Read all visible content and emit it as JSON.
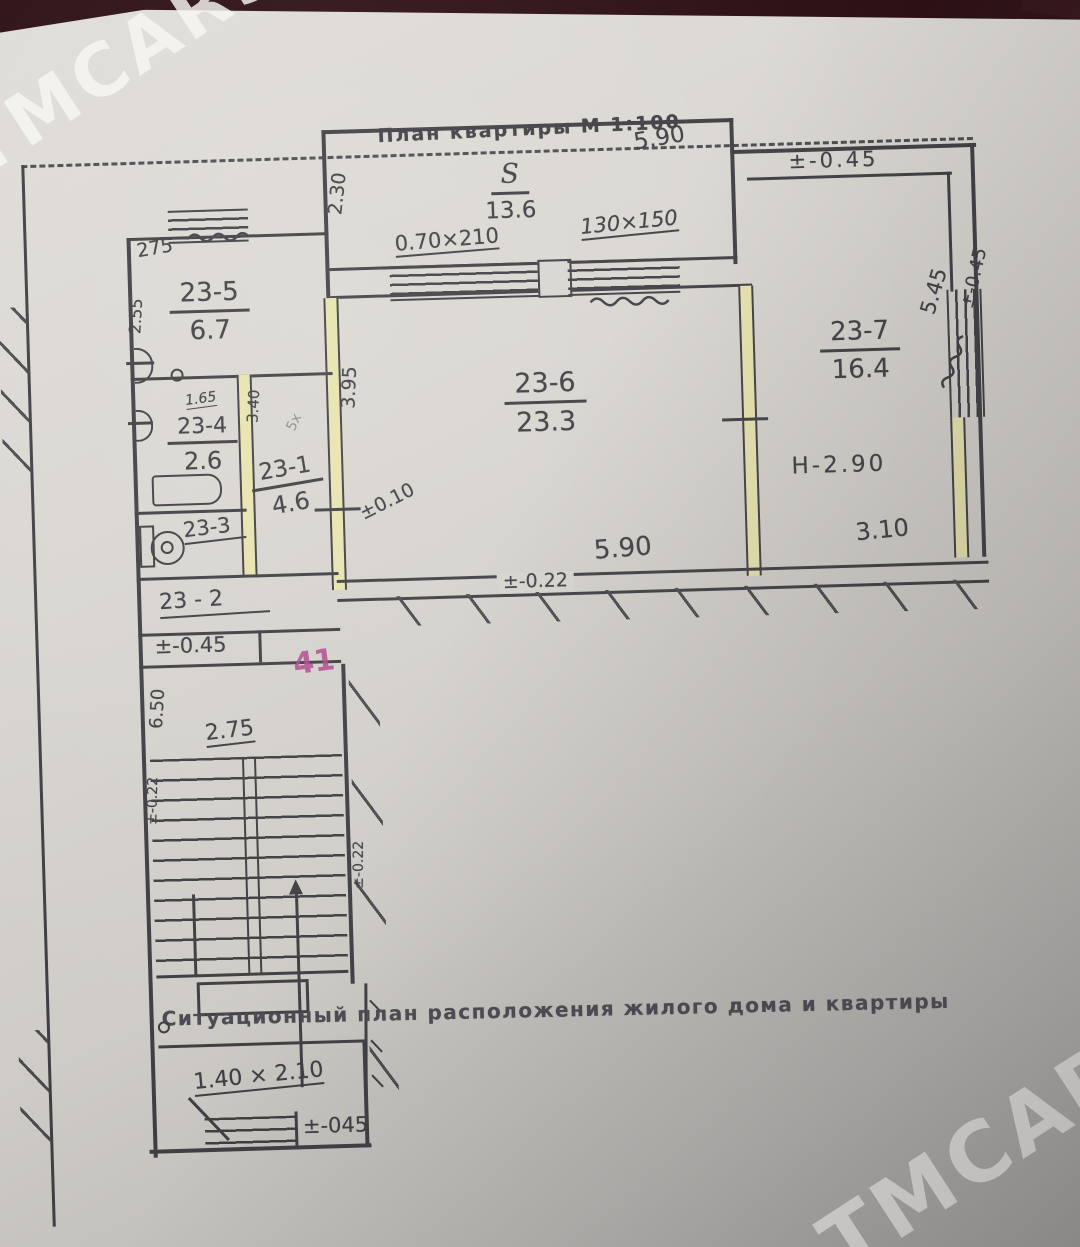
{
  "colors": {
    "ink": "#3f3e43",
    "paper": "#d8d5d0",
    "partition_fill": "#e7e3ae",
    "red_mark": "#b0478d",
    "photo_edge": "#2b0e12"
  },
  "watermark": {
    "text": "TMCARS"
  },
  "header": {
    "title": "План квартиры  М 1:100"
  },
  "balcony": {
    "s_label": "S",
    "area": "13.6",
    "door_dim": "0.70×210",
    "window_dim": "130×150",
    "side_dim": "2.30",
    "top_dim": "5.90"
  },
  "right_wing": {
    "top_level": "±-0.45",
    "side_dim": "5.45",
    "side_level": "±-0.45"
  },
  "rooms": {
    "r237": {
      "number": "23-7",
      "area": "16.4",
      "height_mark": "Н-2.90",
      "width_dim": "3.10"
    },
    "r236": {
      "number": "23-6",
      "area": "23.3",
      "width_dim": "5.90",
      "depth_dim": "3.95",
      "level_mark": "±0.10",
      "bottom_level": "±-0.22"
    },
    "r235": {
      "number": "23-5",
      "area": "6.7",
      "top_dim": "275",
      "side_dim": "2.55"
    },
    "r234": {
      "number": "23-4",
      "area": "2.6",
      "top_dim": "1.65"
    },
    "r233": {
      "number": "23-3"
    },
    "r231": {
      "number": "23-1",
      "area": "4.6",
      "side_dim": "3.40",
      "pencil_note": "5х"
    },
    "r232": {
      "number": "23 - 2"
    }
  },
  "levels": {
    "left_strip": "±-0.45",
    "red_mark": "41"
  },
  "stairs": {
    "height_dim": "6.50",
    "width_dim": "2.75",
    "level_left": "±-0.22",
    "level_right": "±-0.22"
  },
  "porch": {
    "dim": "1.40 × 2.10",
    "level": "±-045"
  },
  "caption": {
    "text": "Ситуационный план расположения жилого дома и квартиры"
  }
}
